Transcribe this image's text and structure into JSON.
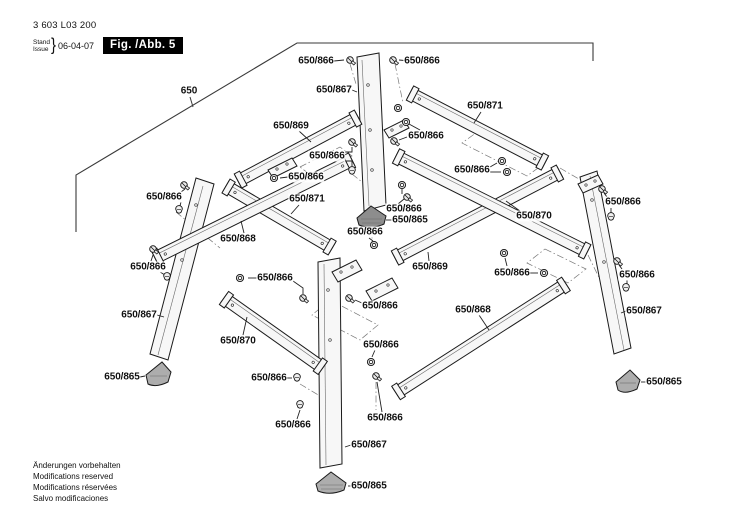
{
  "header": {
    "part_number": "3 603 L03 200",
    "stand_label": "Stand",
    "issue_label": "Issue",
    "brace": "}",
    "date": "06-04-07",
    "figure_label": "Fig. /Abb. 5"
  },
  "footer": {
    "lines": [
      "Änderungen vorbehalten",
      "Modifications reserved",
      "Modifications réservées",
      "Salvo modificaciones"
    ]
  },
  "diagram": {
    "assembly_number": "650",
    "part_numbers": [
      "650",
      "650/865",
      "650/866",
      "650/867",
      "650/868",
      "650/869",
      "650/870",
      "650/871"
    ],
    "colors": {
      "line": "#1a1a1a",
      "part_fill": "#f7f7f7",
      "foot_fill": "#adadad",
      "figure_box_bg": "#000000",
      "figure_box_text": "#ffffff"
    },
    "callouts": [
      {
        "text": "650",
        "x": 189,
        "y": 91
      },
      {
        "text": "650/866",
        "x": 316,
        "y": 61
      },
      {
        "text": "650/866",
        "x": 422,
        "y": 61
      },
      {
        "text": "650/867",
        "x": 334,
        "y": 90
      },
      {
        "text": "650/869",
        "x": 291,
        "y": 126
      },
      {
        "text": "650/871",
        "x": 485,
        "y": 106
      },
      {
        "text": "650/866",
        "x": 426,
        "y": 136
      },
      {
        "text": "650/866",
        "x": 327,
        "y": 156
      },
      {
        "text": "650/866",
        "x": 472,
        "y": 170
      },
      {
        "text": "650/866",
        "x": 306,
        "y": 177
      },
      {
        "text": "650/866",
        "x": 164,
        "y": 197
      },
      {
        "text": "650/871",
        "x": 307,
        "y": 199
      },
      {
        "text": "650/866",
        "x": 623,
        "y": 202
      },
      {
        "text": "650/866",
        "x": 404,
        "y": 209
      },
      {
        "text": "650/870",
        "x": 534,
        "y": 216
      },
      {
        "text": "650/865",
        "x": 410,
        "y": 220
      },
      {
        "text": "650/866",
        "x": 365,
        "y": 232
      },
      {
        "text": "650/868",
        "x": 238,
        "y": 239
      },
      {
        "text": "650/866",
        "x": 148,
        "y": 267
      },
      {
        "text": "650/869",
        "x": 430,
        "y": 267
      },
      {
        "text": "650/866",
        "x": 512,
        "y": 273
      },
      {
        "text": "650/866",
        "x": 637,
        "y": 275
      },
      {
        "text": "650/866",
        "x": 275,
        "y": 278
      },
      {
        "text": "650/866",
        "x": 380,
        "y": 306
      },
      {
        "text": "650/868",
        "x": 473,
        "y": 310
      },
      {
        "text": "650/867",
        "x": 139,
        "y": 315
      },
      {
        "text": "650/867",
        "x": 644,
        "y": 311
      },
      {
        "text": "650/870",
        "x": 238,
        "y": 341
      },
      {
        "text": "650/866",
        "x": 381,
        "y": 345
      },
      {
        "text": "650/866",
        "x": 269,
        "y": 378
      },
      {
        "text": "650/865",
        "x": 122,
        "y": 377
      },
      {
        "text": "650/865",
        "x": 664,
        "y": 382
      },
      {
        "text": "650/866",
        "x": 385,
        "y": 418
      },
      {
        "text": "650/866",
        "x": 293,
        "y": 425
      },
      {
        "text": "650/867",
        "x": 369,
        "y": 445
      },
      {
        "text": "650/865",
        "x": 369,
        "y": 486
      }
    ]
  }
}
